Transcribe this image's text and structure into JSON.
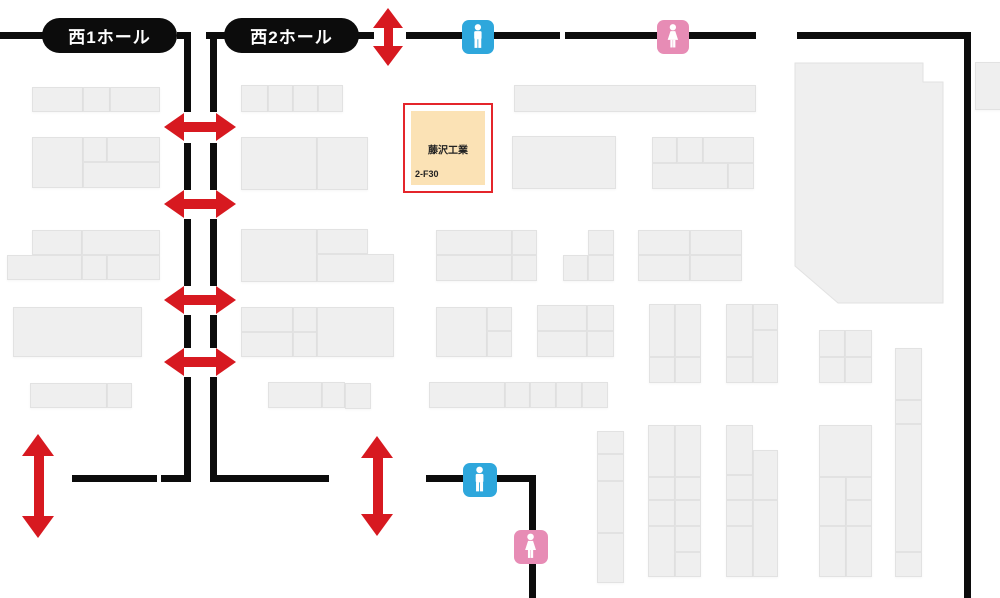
{
  "halls": [
    {
      "label": "西1ホール",
      "x": 42,
      "y": 18,
      "w": 135,
      "h": 35
    },
    {
      "label": "西2ホール",
      "x": 224,
      "y": 18,
      "w": 135,
      "h": 35
    }
  ],
  "highlighted_booth": {
    "company": "藤沢工業",
    "booth_no": "2-F30",
    "x": 403,
    "y": 103,
    "w": 90,
    "h": 90
  },
  "colors": {
    "wall": "#0c0c0c",
    "arrow_red": "#d71920",
    "booth_fill": "#efefef",
    "booth_border": "#e2e2e2",
    "highlight_fill": "#fbe2b5",
    "highlight_border": "#e4252b",
    "male_blue": "#2ea7dc",
    "female_pink": "#e78cb5"
  },
  "upper_right_block": {
    "points": "795,63 923,63 923,82 943,82 943,303 838,303 795,266"
  },
  "booths": [
    [
      32,
      87,
      51,
      25
    ],
    [
      83,
      87,
      27,
      25
    ],
    [
      110,
      87,
      50,
      25
    ],
    [
      32,
      137,
      51,
      51
    ],
    [
      83,
      137,
      24,
      25
    ],
    [
      107,
      137,
      53,
      25
    ],
    [
      83,
      162,
      77,
      26
    ],
    [
      32,
      230,
      50,
      25
    ],
    [
      82,
      230,
      78,
      25
    ],
    [
      7,
      255,
      75,
      25
    ],
    [
      82,
      255,
      25,
      25
    ],
    [
      107,
      255,
      53,
      25
    ],
    [
      13,
      307,
      129,
      50
    ],
    [
      30,
      383,
      77,
      25
    ],
    [
      107,
      383,
      25,
      25
    ],
    [
      241,
      85,
      27,
      27
    ],
    [
      268,
      85,
      25,
      27
    ],
    [
      293,
      85,
      25,
      27
    ],
    [
      318,
      85,
      25,
      27
    ],
    [
      241,
      137,
      76,
      53
    ],
    [
      317,
      137,
      51,
      53
    ],
    [
      241,
      229,
      76,
      53
    ],
    [
      317,
      229,
      51,
      25
    ],
    [
      317,
      254,
      77,
      28
    ],
    [
      241,
      307,
      52,
      25
    ],
    [
      293,
      307,
      24,
      25
    ],
    [
      241,
      332,
      52,
      25
    ],
    [
      293,
      332,
      24,
      25
    ],
    [
      317,
      307,
      77,
      50
    ],
    [
      268,
      382,
      54,
      26
    ],
    [
      322,
      382,
      23,
      26
    ],
    [
      345,
      383,
      26,
      26
    ],
    [
      514,
      85,
      242,
      27
    ],
    [
      512,
      136,
      104,
      53
    ],
    [
      652,
      137,
      25,
      26
    ],
    [
      677,
      137,
      26,
      26
    ],
    [
      703,
      137,
      51,
      26
    ],
    [
      652,
      163,
      76,
      26
    ],
    [
      728,
      163,
      26,
      26
    ],
    [
      436,
      230,
      76,
      25
    ],
    [
      512,
      230,
      25,
      25
    ],
    [
      436,
      255,
      76,
      26
    ],
    [
      512,
      255,
      25,
      26
    ],
    [
      588,
      230,
      26,
      25
    ],
    [
      563,
      255,
      25,
      26
    ],
    [
      588,
      255,
      26,
      26
    ],
    [
      638,
      230,
      52,
      25
    ],
    [
      690,
      230,
      52,
      25
    ],
    [
      638,
      255,
      52,
      26
    ],
    [
      690,
      255,
      52,
      26
    ],
    [
      436,
      307,
      51,
      50
    ],
    [
      487,
      307,
      25,
      24
    ],
    [
      487,
      331,
      25,
      26
    ],
    [
      537,
      305,
      50,
      26
    ],
    [
      587,
      305,
      27,
      26
    ],
    [
      537,
      331,
      50,
      26
    ],
    [
      587,
      331,
      27,
      26
    ],
    [
      649,
      304,
      26,
      53
    ],
    [
      675,
      304,
      26,
      53
    ],
    [
      649,
      357,
      26,
      26
    ],
    [
      675,
      357,
      26,
      26
    ],
    [
      726,
      304,
      27,
      53
    ],
    [
      726,
      357,
      27,
      26
    ],
    [
      753,
      304,
      25,
      26
    ],
    [
      753,
      330,
      25,
      53
    ],
    [
      819,
      330,
      26,
      27
    ],
    [
      845,
      330,
      27,
      27
    ],
    [
      819,
      357,
      26,
      26
    ],
    [
      845,
      357,
      27,
      26
    ],
    [
      429,
      382,
      76,
      26
    ],
    [
      505,
      382,
      25,
      26
    ],
    [
      530,
      382,
      26,
      26
    ],
    [
      556,
      382,
      26,
      26
    ],
    [
      582,
      382,
      26,
      26
    ],
    [
      597,
      431,
      27,
      23
    ],
    [
      597,
      454,
      27,
      27
    ],
    [
      597,
      481,
      27,
      52
    ],
    [
      597,
      533,
      27,
      50
    ],
    [
      648,
      425,
      27,
      52
    ],
    [
      648,
      477,
      27,
      23
    ],
    [
      648,
      500,
      27,
      26
    ],
    [
      648,
      526,
      27,
      51
    ],
    [
      675,
      425,
      26,
      52
    ],
    [
      675,
      477,
      26,
      23
    ],
    [
      675,
      500,
      26,
      26
    ],
    [
      675,
      526,
      26,
      26
    ],
    [
      675,
      552,
      26,
      25
    ],
    [
      726,
      425,
      27,
      50
    ],
    [
      726,
      475,
      27,
      25
    ],
    [
      726,
      500,
      27,
      26
    ],
    [
      726,
      526,
      27,
      51
    ],
    [
      753,
      450,
      25,
      50
    ],
    [
      753,
      500,
      25,
      77
    ],
    [
      819,
      425,
      53,
      52
    ],
    [
      819,
      477,
      27,
      49
    ],
    [
      819,
      526,
      27,
      51
    ],
    [
      846,
      477,
      26,
      23
    ],
    [
      846,
      500,
      26,
      26
    ],
    [
      846,
      526,
      26,
      51
    ],
    [
      895,
      348,
      27,
      52
    ],
    [
      895,
      400,
      27,
      24
    ],
    [
      895,
      424,
      27,
      128
    ],
    [
      895,
      552,
      27,
      25
    ],
    [
      975,
      62,
      30,
      48
    ]
  ],
  "walls": [
    [
      0,
      32,
      44,
      7
    ],
    [
      177,
      32,
      14,
      7
    ],
    [
      206,
      32,
      19,
      7
    ],
    [
      358,
      32,
      16,
      7
    ],
    [
      406,
      32,
      154,
      7
    ],
    [
      565,
      32,
      191,
      7
    ],
    [
      797,
      32,
      174,
      7
    ],
    [
      184,
      32,
      7,
      80
    ],
    [
      210,
      32,
      7,
      80
    ],
    [
      184,
      143,
      7,
      47
    ],
    [
      210,
      143,
      7,
      47
    ],
    [
      184,
      219,
      7,
      67
    ],
    [
      210,
      219,
      7,
      67
    ],
    [
      184,
      315,
      7,
      33
    ],
    [
      210,
      315,
      7,
      33
    ],
    [
      184,
      377,
      7,
      105
    ],
    [
      210,
      377,
      7,
      105
    ],
    [
      964,
      32,
      7,
      566
    ],
    [
      72,
      475,
      85,
      7
    ],
    [
      161,
      475,
      30,
      7
    ],
    [
      210,
      475,
      119,
      7
    ],
    [
      426,
      475,
      110,
      7
    ],
    [
      529,
      475,
      7,
      123
    ]
  ],
  "arrows": [
    {
      "dir": "h",
      "x": 164,
      "y": 113,
      "w": 72,
      "h": 28
    },
    {
      "dir": "h",
      "x": 164,
      "y": 190,
      "w": 72,
      "h": 28
    },
    {
      "dir": "h",
      "x": 164,
      "y": 286,
      "w": 72,
      "h": 28
    },
    {
      "dir": "h",
      "x": 164,
      "y": 348,
      "w": 72,
      "h": 28
    },
    {
      "dir": "v",
      "x": 373,
      "y": 8,
      "w": 30,
      "h": 58
    },
    {
      "dir": "v",
      "x": 22,
      "y": 434,
      "w": 33,
      "h": 104
    },
    {
      "dir": "v",
      "x": 361,
      "y": 436,
      "w": 33,
      "h": 100
    }
  ],
  "restrooms": [
    {
      "type": "male",
      "x": 462,
      "y": 20,
      "w": 32,
      "h": 34
    },
    {
      "type": "female",
      "x": 657,
      "y": 20,
      "w": 32,
      "h": 34
    },
    {
      "type": "male",
      "x": 463,
      "y": 463,
      "w": 34,
      "h": 34
    },
    {
      "type": "female",
      "x": 514,
      "y": 530,
      "w": 34,
      "h": 34
    }
  ]
}
